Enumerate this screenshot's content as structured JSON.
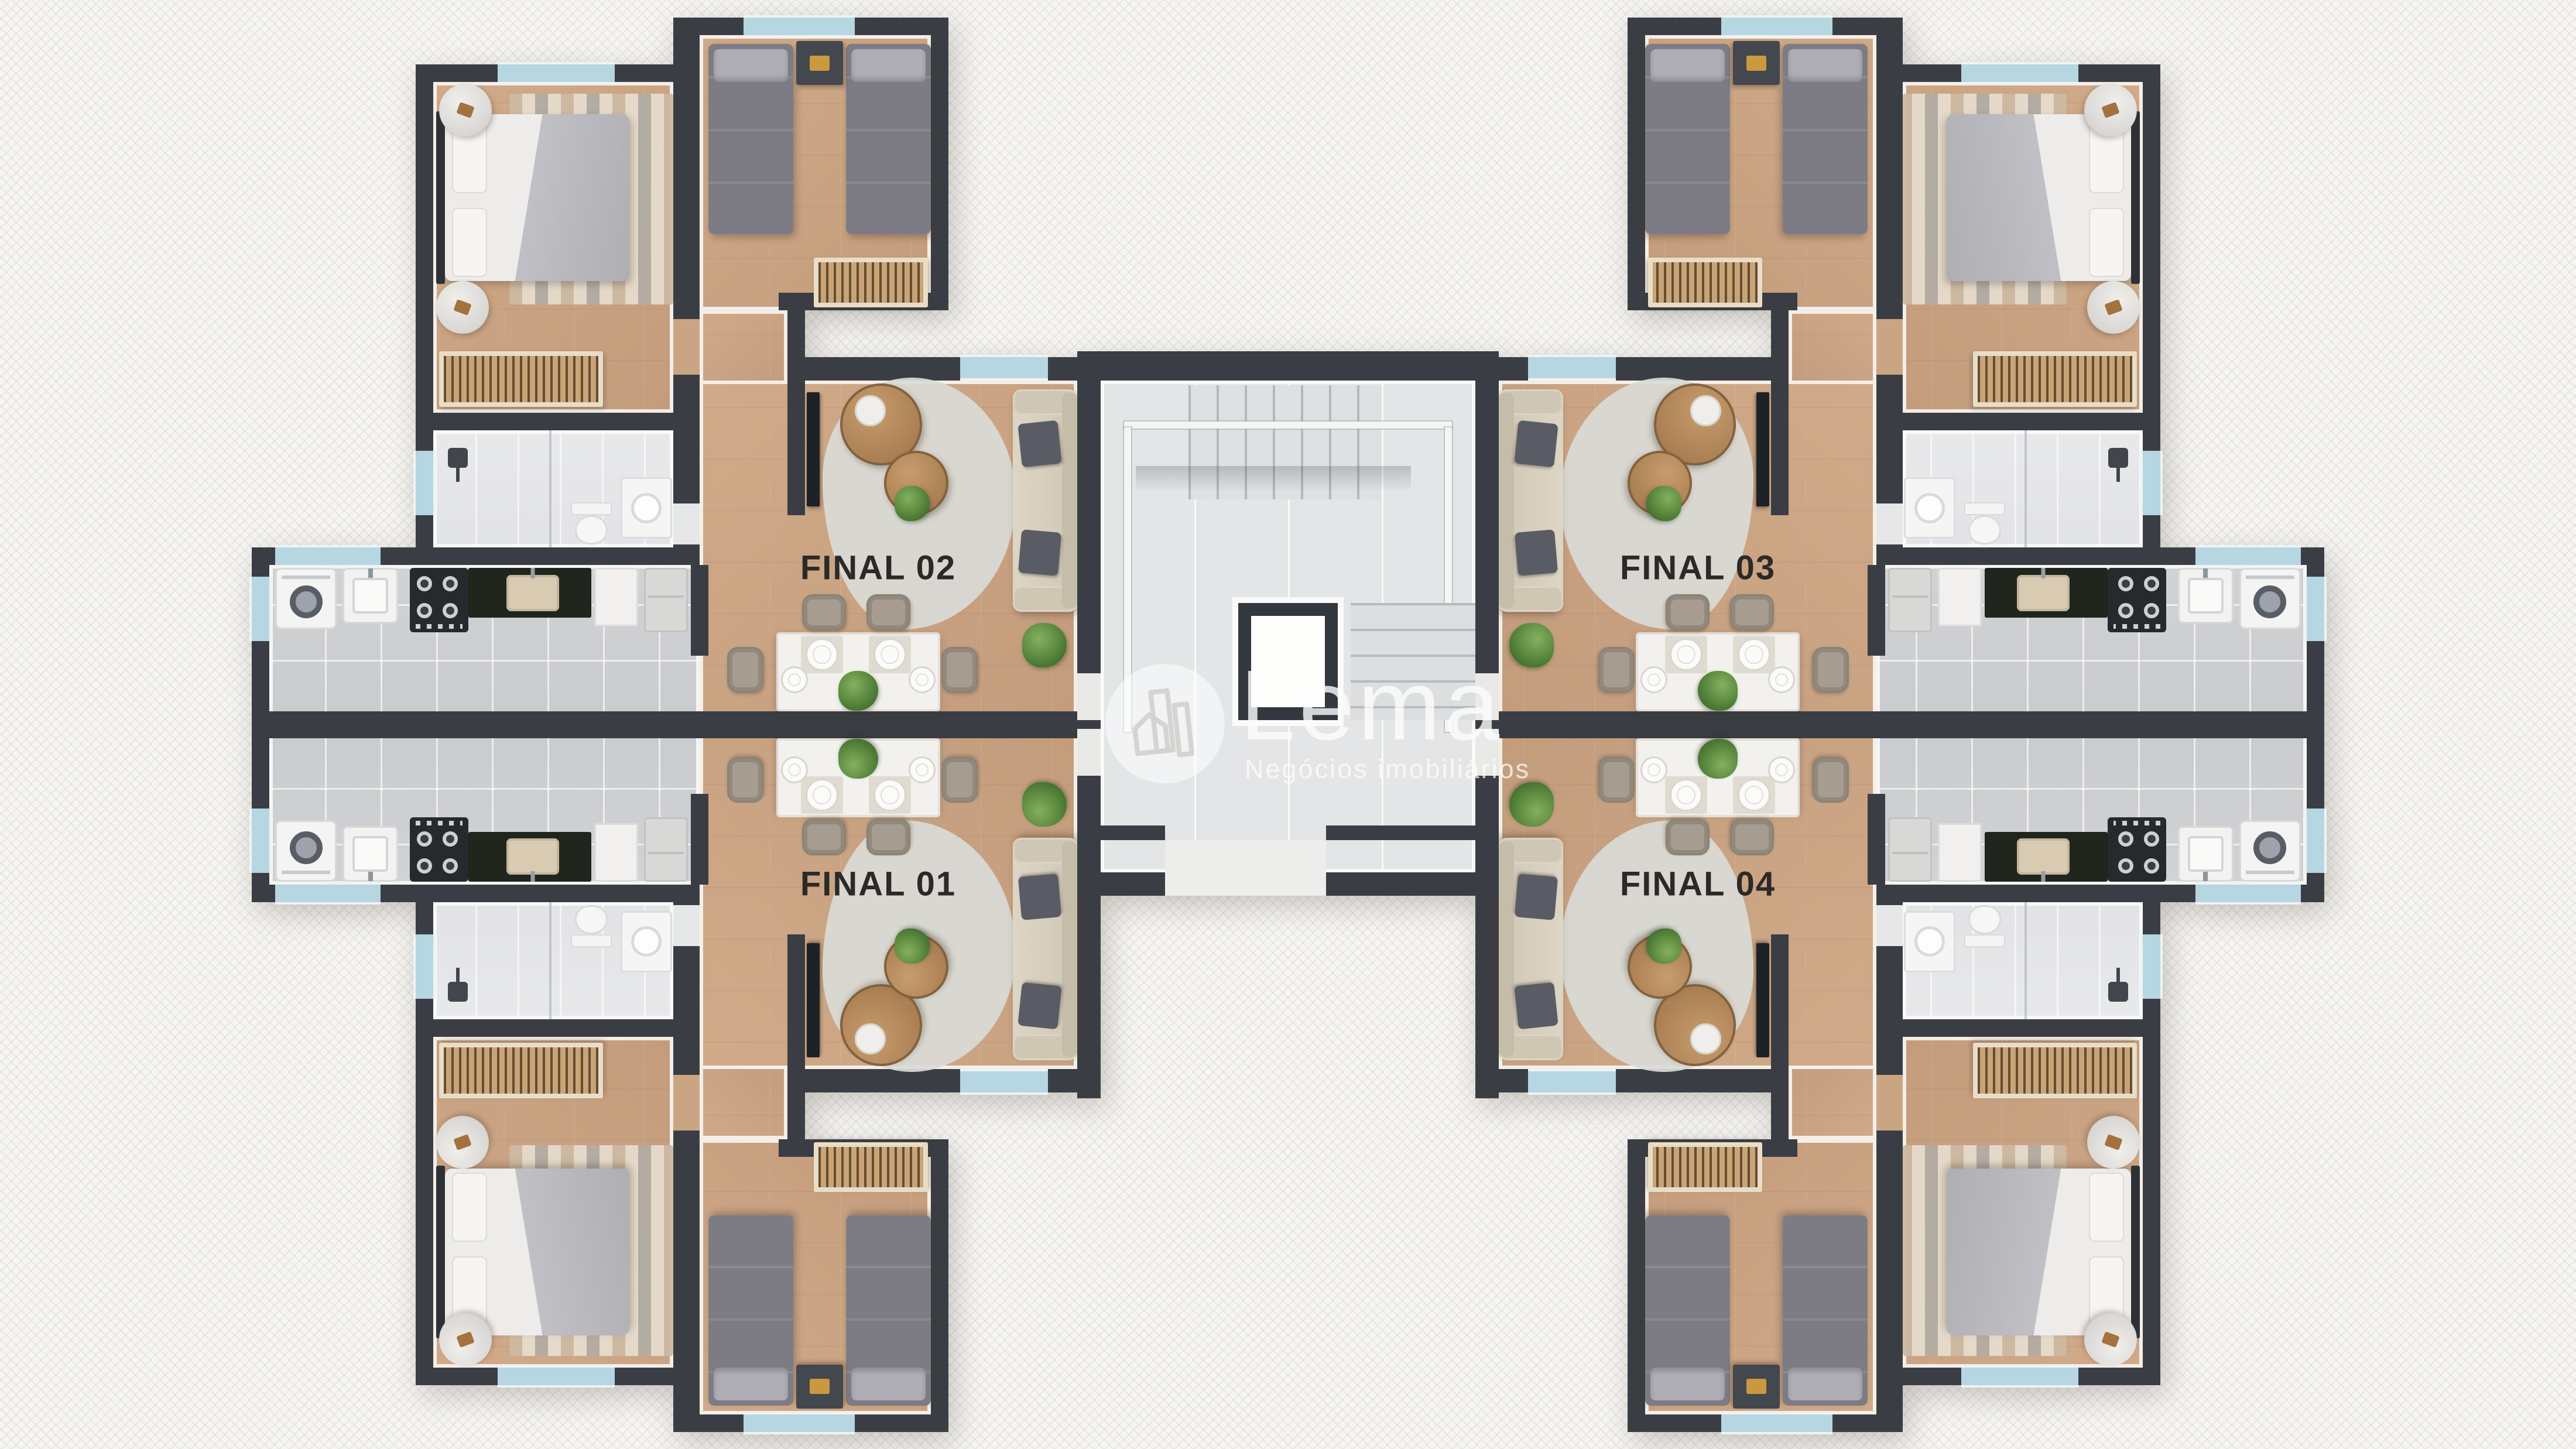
{
  "units": [
    {
      "id": "final-01",
      "label": "FINAL 01",
      "position": "lower-left"
    },
    {
      "id": "final-02",
      "label": "FINAL 02",
      "position": "upper-left"
    },
    {
      "id": "final-03",
      "label": "FINAL 03",
      "position": "upper-right"
    },
    {
      "id": "final-04",
      "label": "FINAL 04",
      "position": "lower-right"
    }
  ],
  "watermark": {
    "brand": "Lema",
    "tagline": "Negócios imobiliários",
    "logo": "buildings-and-house-icon"
  },
  "shared_areas": [
    "stair-hall",
    "central-stair-void",
    "building-entrance-vestibule"
  ],
  "unit_rooms": [
    "double-bedroom",
    "twin-bedroom",
    "bathroom",
    "kitchen-laundry",
    "living-room",
    "dining-area",
    "corridor"
  ],
  "furniture_icons": [
    "double-bed",
    "single-bed",
    "nightstand",
    "wardrobe",
    "round-side-table",
    "striped-rug",
    "tv-panel",
    "sofa",
    "sofa-cushion",
    "coffee-table",
    "floor-plant",
    "dining-table",
    "dining-chair",
    "plate",
    "placemat",
    "centerpiece-plant",
    "washing-machine",
    "laundry-tank",
    "stove",
    "kitchen-counter",
    "kitchen-sink",
    "cabinet",
    "fridge",
    "toilet",
    "shower-head",
    "shower-glass",
    "vanity-sink",
    "window",
    "door-opening",
    "stair-flight",
    "stair-railing"
  ],
  "colors": {
    "bg": "#f6f5f2",
    "wall": "#3a3e44",
    "wood": "#c39c7c",
    "wood2": "#d0aa89",
    "window": "#b6d6e2",
    "duvet": "#edecea",
    "blanket": "#c4c4c9",
    "twin": "#7d7c84",
    "sofa": "#ddd5c5",
    "cushion": "#595c64",
    "stove": "#26292d",
    "counter": "#20251d",
    "gold": "#c9983f",
    "void": "#33383e",
    "label": "#2b2a28"
  }
}
